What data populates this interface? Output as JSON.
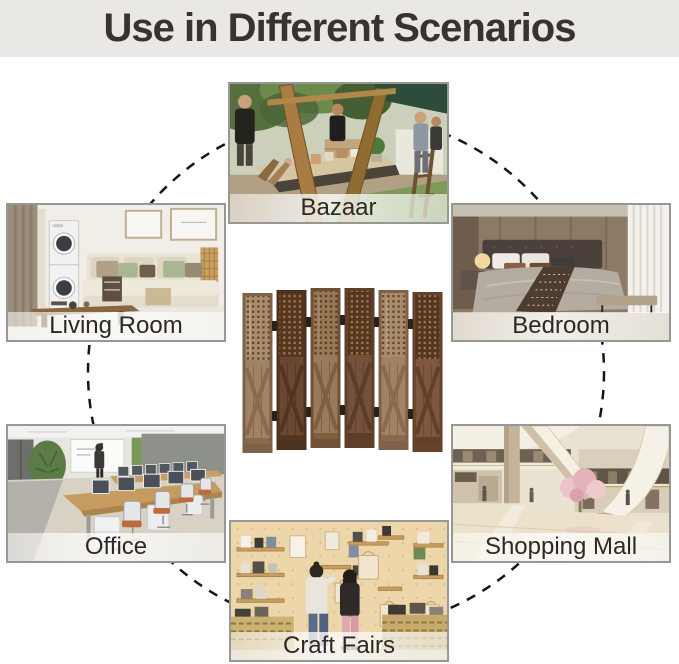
{
  "title": "Use in Different Scenarios",
  "scenarios": [
    {
      "id": "bazaar",
      "label": "Bazaar"
    },
    {
      "id": "living-room",
      "label": "Living Room"
    },
    {
      "id": "bedroom",
      "label": "Bedroom"
    },
    {
      "id": "office",
      "label": "Office"
    },
    {
      "id": "shopping-mall",
      "label": "Shopping Mall"
    },
    {
      "id": "craft-fairs",
      "label": "Craft Fairs"
    }
  ],
  "colors": {
    "title_bg": "#e9e8e4",
    "title_text": "#37332e",
    "dash": "#161616",
    "caption_text": "#2c2925",
    "tile_border": "#979795"
  }
}
